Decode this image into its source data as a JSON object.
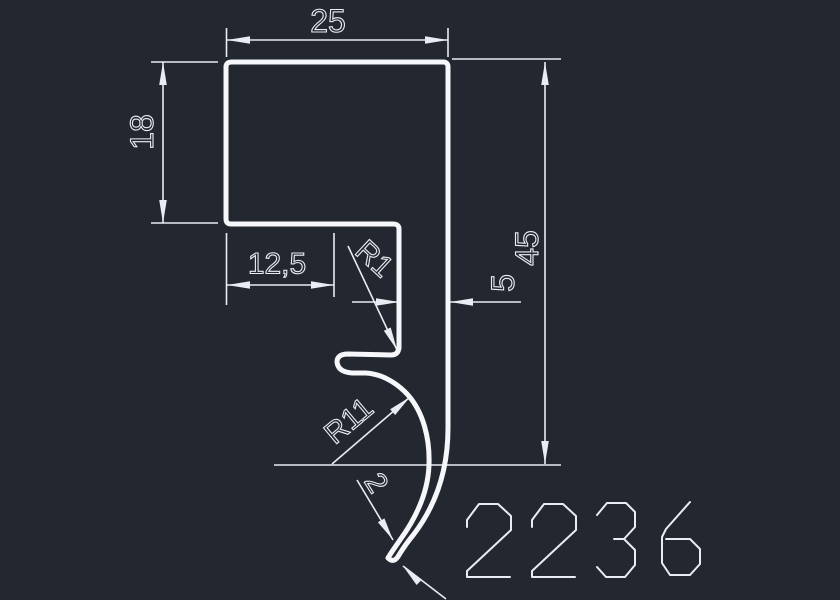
{
  "canvas": {
    "width": 840,
    "height": 600,
    "background": "#23272f"
  },
  "style": {
    "profile_color": "#f5f7fa",
    "profile_stroke_width": 5,
    "dim_color": "#e9ecf2",
    "dim_stroke_width": 1.6,
    "text_stroke_width": 1.1,
    "arrow_length": 23,
    "arrow_half_width": 3.8
  },
  "profile": {
    "name": "extrusion-profile-outline",
    "path": "M 232 62 L 443 62 Q 448 62 448 67 L 448 428 C 448 470 436 505 414 534 Q 405 545 399 555 Q 394 564 388 558 C 392 551 396 546 400 540 C 416 518 428 492 429 465 C 430 438 423 412 408 395 C 398 384 383 374 366 373 L 352 373 Q 338 372 337 362 Q 337 354 348 354 L 391 355 Q 398 355 399 348 L 399 229 Q 399 224 393 224 L 231 224 Q 226 224 226 219 L 226 67 Q 226 62 232 62 Z"
  },
  "dimensions": [
    {
      "name": "top-width",
      "label": "25",
      "lines": [
        [
          226.5,
          28,
          226.5,
          57
        ],
        [
          448,
          28,
          448,
          57
        ],
        [
          227,
          40,
          448,
          40
        ]
      ],
      "arrows": [
        [
          227,
          40,
          180
        ],
        [
          448,
          40,
          0
        ]
      ],
      "text": {
        "x": 328,
        "y": 21,
        "rot": 0,
        "size": 32
      }
    },
    {
      "name": "left-height",
      "label": "18",
      "lines": [
        [
          151,
          62,
          218,
          62
        ],
        [
          151,
          223,
          218,
          223
        ],
        [
          163,
          62,
          163,
          223
        ]
      ],
      "arrows": [
        [
          163,
          62,
          270
        ],
        [
          163,
          223,
          90
        ]
      ],
      "text": {
        "x": 142,
        "y": 132,
        "rot": -90,
        "size": 32
      }
    },
    {
      "name": "step-width",
      "label": "12,5",
      "lines": [
        [
          226.5,
          233,
          226.5,
          305
        ],
        [
          334,
          233,
          334,
          297
        ],
        [
          227,
          285,
          334,
          285
        ]
      ],
      "arrows": [
        [
          227,
          285,
          180
        ],
        [
          334,
          285,
          0
        ]
      ],
      "text": {
        "x": 277,
        "y": 264,
        "rot": 0,
        "size": 30
      }
    },
    {
      "name": "inner-radius",
      "label": "R1",
      "lines": [
        [
          348,
          246,
          397,
          350
        ]
      ],
      "arrows": [
        [
          397,
          350,
          65
        ]
      ],
      "text": {
        "x": 374,
        "y": 259,
        "rot": 43,
        "size": 30
      }
    },
    {
      "name": "wall-width",
      "label": "5",
      "lines": [
        [
          352,
          302,
          399,
          302
        ],
        [
          450,
          302,
          521,
          302
        ]
      ],
      "arrows": [
        [
          399,
          302,
          0
        ],
        [
          450,
          302,
          180
        ]
      ],
      "text": {
        "x": 503,
        "y": 283,
        "rot": -90,
        "size": 32
      }
    },
    {
      "name": "right-height",
      "label": "45",
      "lines": [
        [
          452,
          59,
          561,
          59
        ],
        [
          274,
          465,
          561,
          465
        ],
        [
          545,
          62,
          545,
          464
        ]
      ],
      "arrows": [
        [
          545,
          62,
          270
        ],
        [
          545,
          464,
          90
        ]
      ],
      "text": {
        "x": 527,
        "y": 248,
        "rot": -90,
        "size": 32
      }
    },
    {
      "name": "hook-radius",
      "label": "R11",
      "lines": [
        [
          332,
          464,
          410,
          397
        ]
      ],
      "arrows": [
        [
          410,
          397,
          -41
        ]
      ],
      "text": {
        "x": 349,
        "y": 421,
        "rot": -40,
        "size": 30
      }
    },
    {
      "name": "tip-thickness",
      "label": "2",
      "lines": [
        [
          357,
          480,
          393,
          540
        ],
        [
          403,
          566,
          446,
          599
        ]
      ],
      "arrows": [
        [
          393,
          540,
          59
        ],
        [
          403,
          566,
          225
        ]
      ],
      "text": {
        "x": 376,
        "y": 483,
        "rot": 58,
        "size": 30
      }
    }
  ],
  "part_number": {
    "text": "2236",
    "x": 465,
    "y": 501,
    "advance": 65,
    "stroke_width": 2,
    "glyphs": {
      "2": [
        [
          [
            2,
            26
          ],
          [
            2,
            19
          ],
          [
            14,
            3
          ],
          [
            33,
            3
          ],
          [
            46,
            15
          ],
          [
            46,
            29
          ],
          [
            2,
            70
          ],
          [
            2,
            76
          ],
          [
            45,
            76
          ]
        ]
      ],
      "3": [
        [
          [
            2,
            14
          ],
          [
            12,
            2
          ],
          [
            31,
            2
          ],
          [
            40,
            11
          ],
          [
            40,
            26
          ],
          [
            29,
            38
          ],
          [
            19,
            38
          ],
          [
            29,
            38
          ],
          [
            40,
            49
          ],
          [
            40,
            64
          ],
          [
            30,
            76
          ],
          [
            11,
            76
          ],
          [
            2,
            66
          ]
        ]
      ],
      "6": [
        [
          [
            30,
            1
          ],
          [
            6,
            28
          ],
          [
            2,
            36
          ],
          [
            2,
            62
          ],
          [
            10,
            74
          ],
          [
            30,
            74
          ],
          [
            40,
            63
          ],
          [
            40,
            48
          ],
          [
            30,
            38
          ],
          [
            6,
            38
          ]
        ]
      ]
    }
  }
}
